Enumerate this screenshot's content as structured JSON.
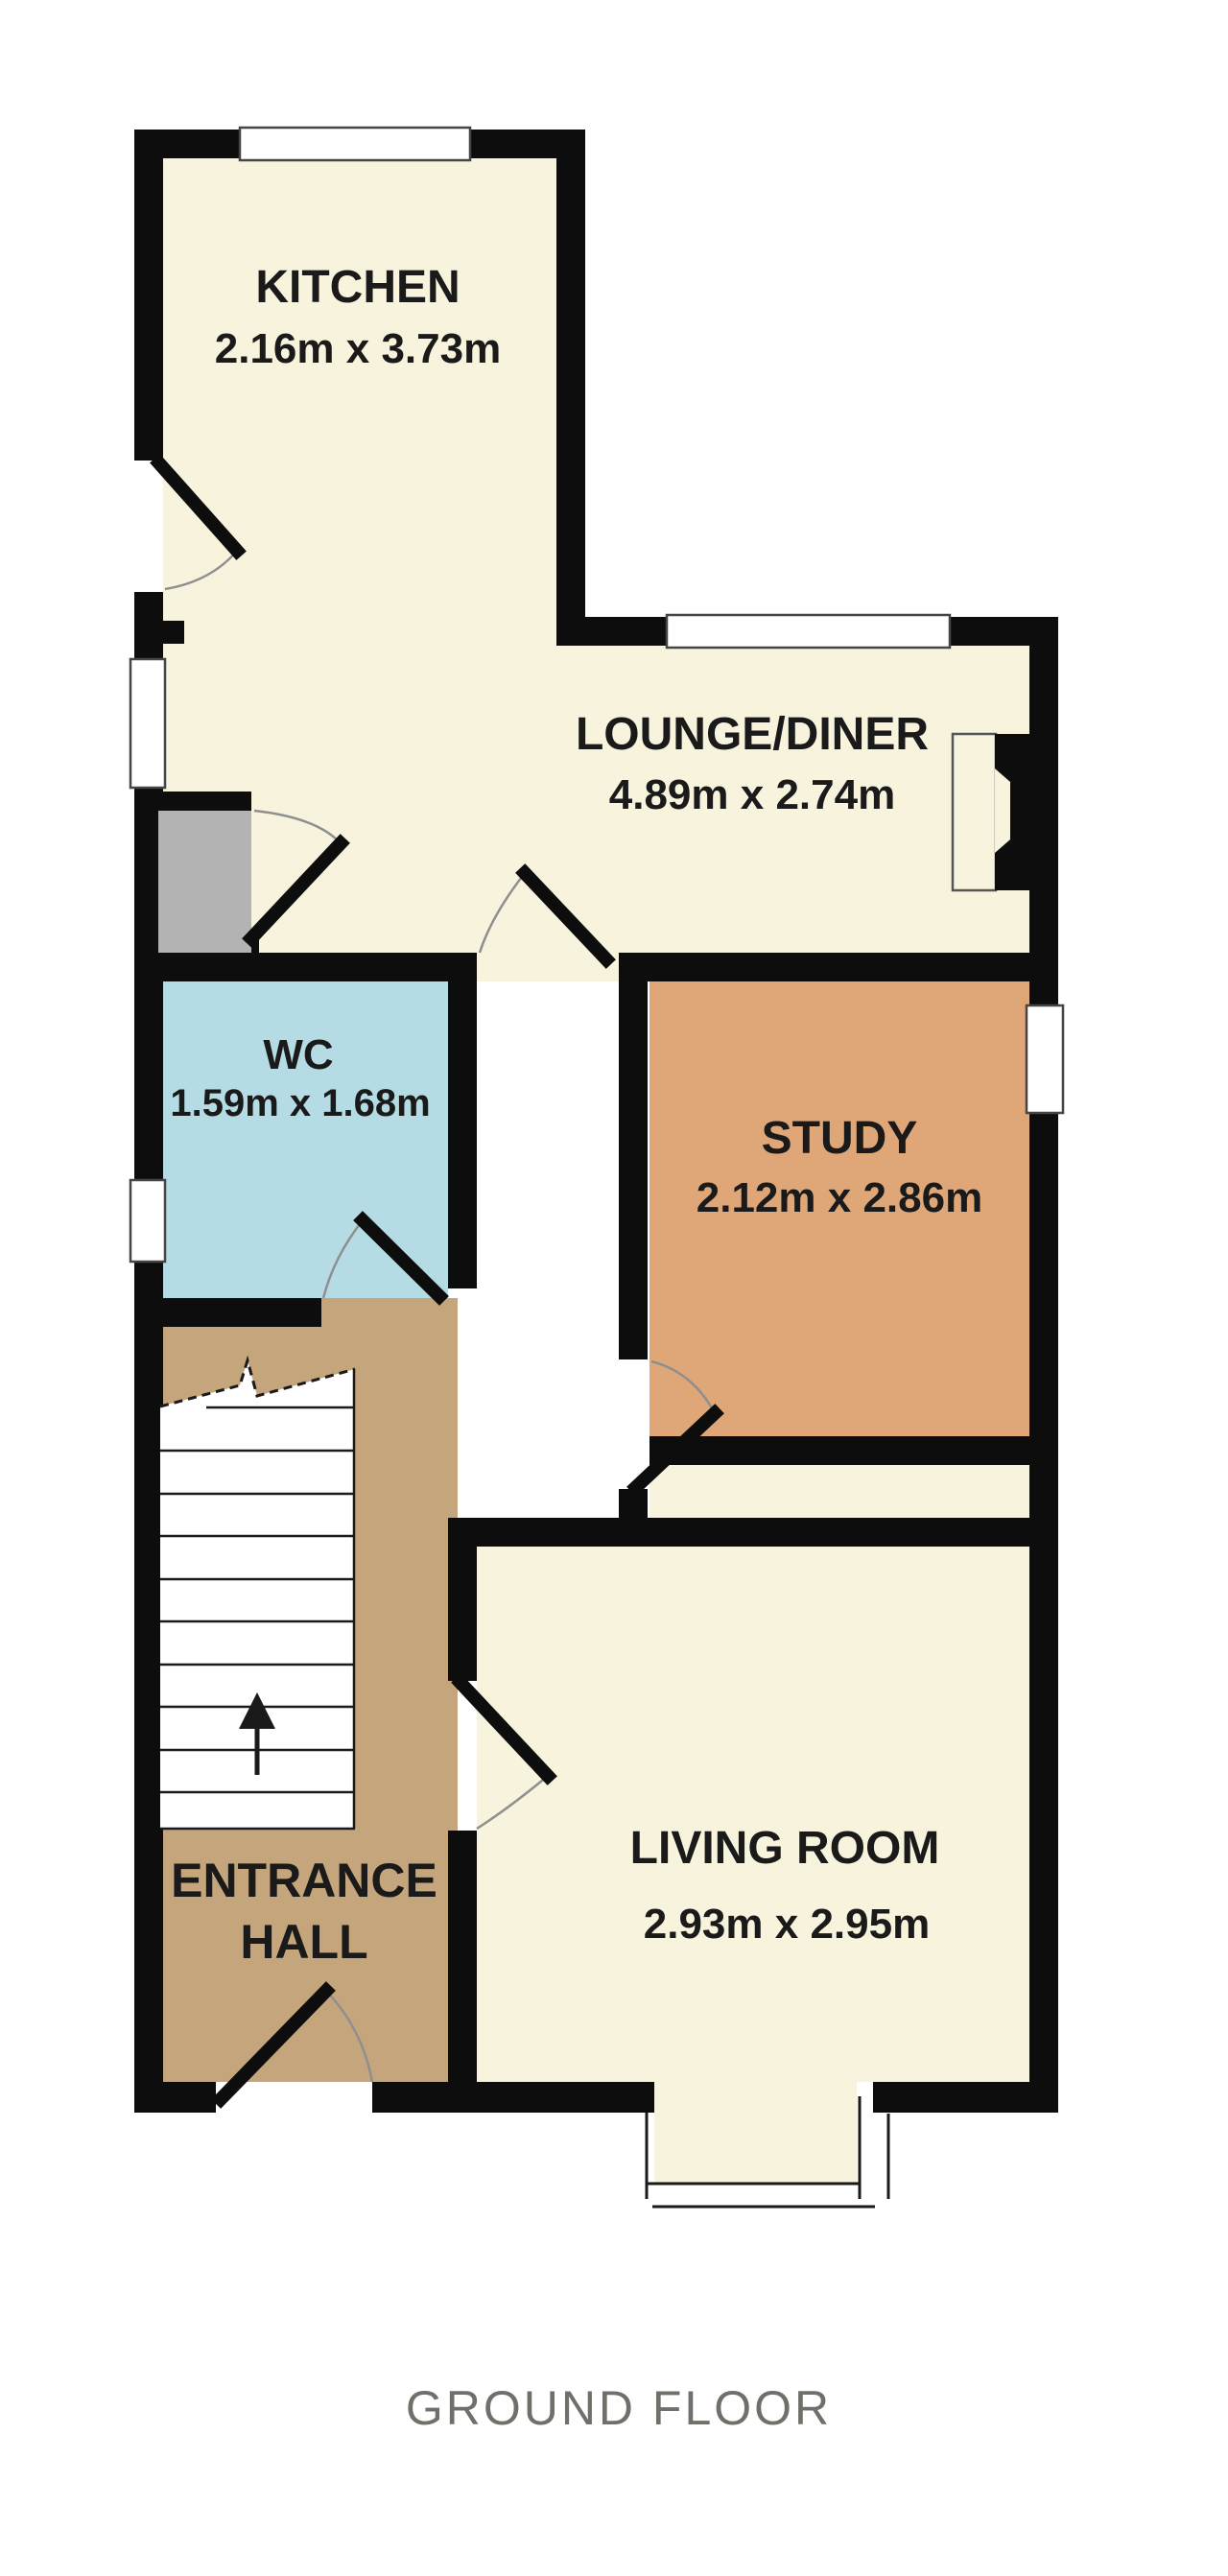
{
  "floor_label": "GROUND FLOOR",
  "rooms": {
    "kitchen": {
      "name": "KITCHEN",
      "dims": "2.16m x 3.73m"
    },
    "lounge_diner": {
      "name": "LOUNGE/DINER",
      "dims": "4.89m x 2.74m"
    },
    "wc": {
      "name": "WC",
      "dims": "1.59m x 1.68m"
    },
    "study": {
      "name": "STUDY",
      "dims": "2.12m x 2.86m"
    },
    "entrance_hall": {
      "name_line1": "ENTRANCE",
      "name_line2": "HALL"
    },
    "living_room": {
      "name": "LIVING ROOM",
      "dims": "2.93m x 2.95m"
    }
  },
  "colors": {
    "wall": "#0d0d0d",
    "reception_floor": "#f7f3dc",
    "hall_floor": "#c5a67c",
    "wc_floor": "#b5dce4",
    "study_floor": "#dfa678",
    "cupboard": "#b3b3b3",
    "stairs": "#ffffff",
    "room_label_text": "#1a1a1a",
    "floor_label_text": "#716f6a"
  }
}
